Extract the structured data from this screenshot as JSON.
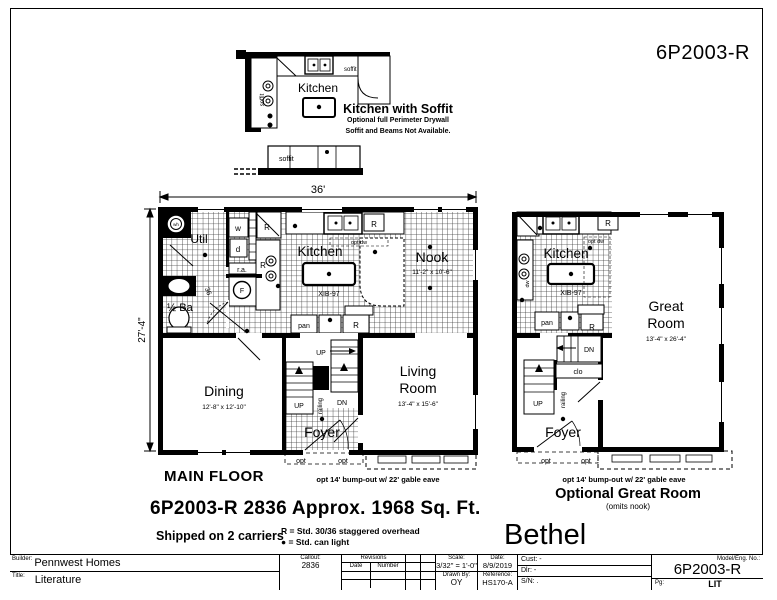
{
  "header": {
    "model": "6P2003-R"
  },
  "inset": {
    "kitchen": "Kitchen",
    "soffit_left": "soffit",
    "soffit_top": "soffit",
    "soffit_bottom": "soffit",
    "title": "Kitchen with Soffit",
    "note1": "Optional full Perimeter Drywall",
    "note2": "Soffit and Beams Not Available."
  },
  "main": {
    "caption": "MAIN FLOOR",
    "dim_w": "36'",
    "dim_h": "27'-4\"",
    "bumpout": "opt 14' bump-out w/ 22' gable eave",
    "wh": "wh",
    "util": "Util",
    "w": "w",
    "d": "d",
    "ra": "r.a.",
    "f": "F",
    "n36": "36",
    "half_ba": "½ Ba",
    "r": "R",
    "opt_dw": "opt dw",
    "kitchen": "Kitchen",
    "island": "XIB-97",
    "nook": "Nook",
    "nook_dims": "11'-2\" x 10'-6\"",
    "pan": "pan",
    "dining": "Dining",
    "dining_dims": "12'-8\" x 12'-10\"",
    "up": "UP",
    "dn": "DN",
    "railing": "railing",
    "foyer": "Foyer",
    "living1": "Living",
    "living2": "Room",
    "living_dims": "13'-4\" x 15'-6\"",
    "opt": "opt"
  },
  "alt": {
    "caption": "Optional Great Room",
    "subcaption": "(omits nook)",
    "bumpout": "opt 14' bump-out w/ 22' gable eave",
    "kitchen": "Kitchen",
    "opt_dw": "opt dw",
    "island": "XIB-97",
    "r": "R",
    "pan": "pan",
    "dw": "dw",
    "great1": "Great",
    "great2": "Room",
    "great_dims": "13'-4\" x 26'-4\"",
    "dn": "DN",
    "clo": "clo",
    "up": "UP",
    "railing": "railing",
    "foyer": "Foyer",
    "opt": "opt"
  },
  "notes": {
    "model_line": "6P2003-R 2836  Approx. 1968 Sq. Ft.",
    "shipped": "Shipped on 2 carriers",
    "legend_r": "R = Std. 30/36 staggered overhead",
    "legend_dot": "● = Std. can light",
    "series": "Bethel"
  },
  "title_block": {
    "builder_label": "Builder:",
    "builder": "Pennwest Homes",
    "title_label": "Title:",
    "title": "Literature",
    "callout_label": "Callout:",
    "callout": "2836",
    "revisions_label": "Revisions",
    "rev_date": "Date",
    "rev_number": "Number",
    "scale_label": "Scale:",
    "scale": "3/32\" = 1'-0\"",
    "date_label": "Date:",
    "date": "8/9/2019",
    "drawn_label": "Drawn By:",
    "drawn": "OY",
    "ref_label": "Reference:",
    "reference": "HS170-A",
    "cust_label": "Cust:",
    "cust": "-",
    "dlr_label": "Dlr:",
    "dlr": "-",
    "sn_label": "S/N:",
    "sn": ".",
    "model_label": "Model/Eng. No.:",
    "model": "6P2003-R",
    "pg_label": "Pg:",
    "pg": "LIT"
  }
}
